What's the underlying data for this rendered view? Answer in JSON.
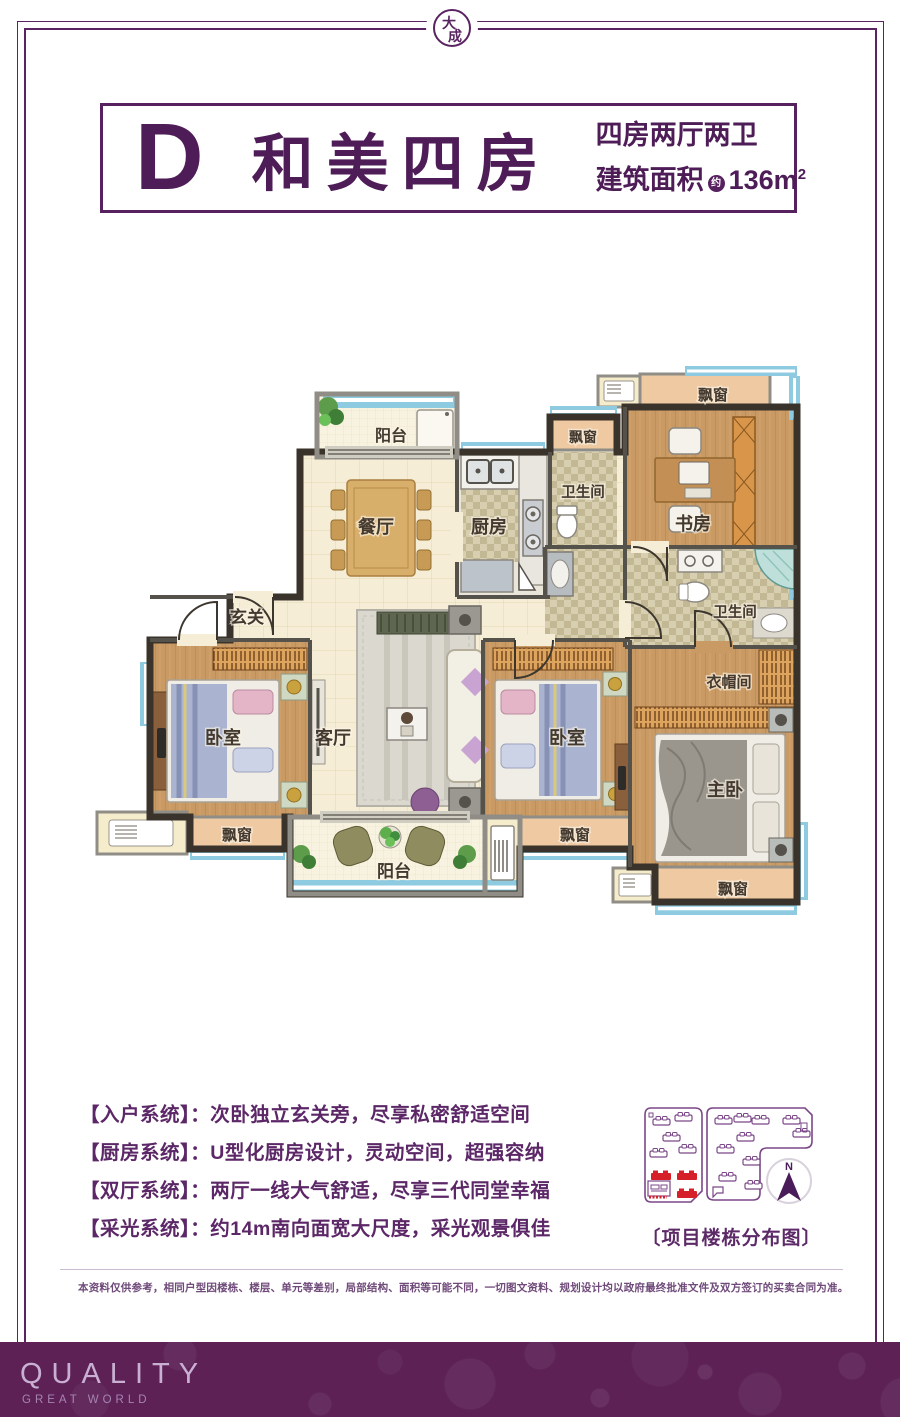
{
  "frame": {
    "logo_char1": "大",
    "logo_char2": "成"
  },
  "header": {
    "unit_letter": "D",
    "unit_name": "和美四房",
    "spec": "四房两厅两卫",
    "area_label": "建筑面积",
    "area_approx": "约",
    "area_value": "136m",
    "area_sup": "2"
  },
  "floorplan": {
    "rooms": {
      "balcony_top": "阳台",
      "dining": "餐厅",
      "kitchen": "厨房",
      "bath_top": "卫生间",
      "bay_top": "飘窗",
      "study": "书房",
      "bay_study": "飘窗",
      "foyer": "玄关",
      "bedroom_left": "卧室",
      "living": "客厅",
      "bay_left": "飘窗",
      "balcony_bottom": "阳台",
      "bedroom_mid": "卧室",
      "bay_mid": "飘窗",
      "bath_right": "卫生间",
      "cloakroom": "衣帽间",
      "master": "主卧",
      "bay_master": "飘窗"
    }
  },
  "features": [
    {
      "label": "【入户系统】",
      "text": "：次卧独立玄关旁，尽享私密舒适空间"
    },
    {
      "label": "【厨房系统】",
      "text": "：U型化厨房设计，灵动空间，超强容纳"
    },
    {
      "label": "【双厅系统】",
      "text": "：两厅一线大气舒适，尽享三代同堂幸福"
    },
    {
      "label": "【采光系统】",
      "text": "：约14m南向面宽大尺度，采光观景俱佳"
    }
  ],
  "sitemap": {
    "caption": "〔项目楼栋分布图〕",
    "compass": "N"
  },
  "disclaimer": "本资料仅供参考，相同户型因楼栋、楼层、单元等差别，局部结构、面积等可能不同，一切图文资料、规划设计均以政府最终批准文件及双方签订的买卖合同为准。",
  "footer": {
    "title": "QUALITY",
    "subtitle": "GREAT WORLD"
  },
  "colors": {
    "purple": "#5a2362",
    "footer_bg": "#5d2156",
    "red": "#d5202a"
  }
}
